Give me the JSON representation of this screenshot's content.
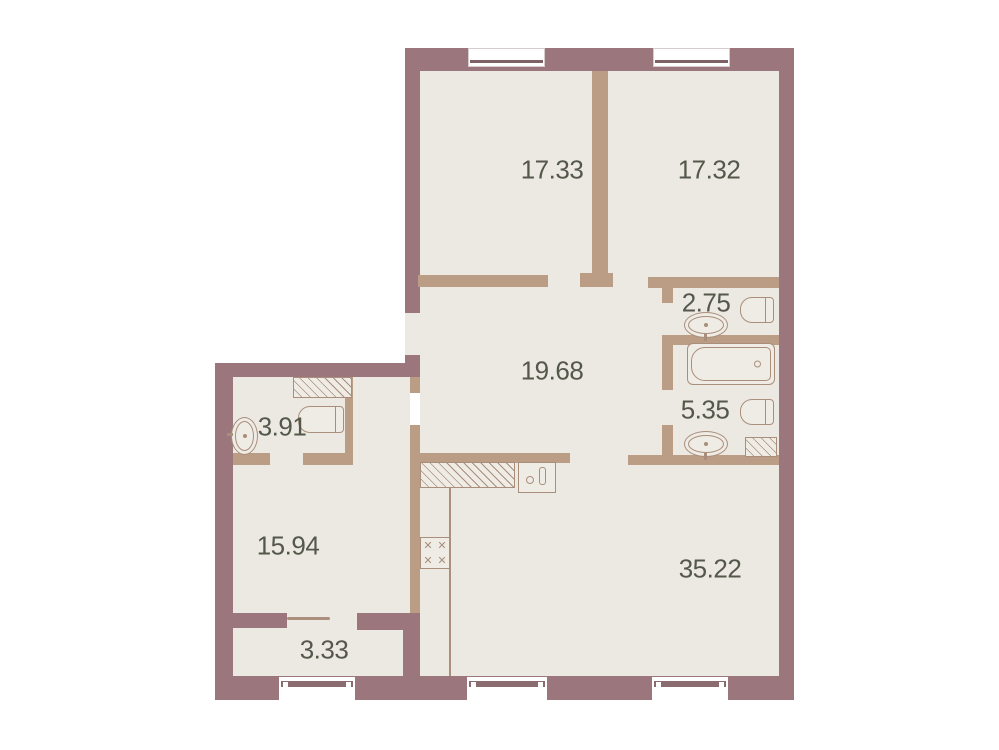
{
  "title": "apartment-floor-plan",
  "areas": {
    "bedroom_top_left": "17.33",
    "bedroom_top_right": "17.32",
    "wc_small": "2.75",
    "hallway": "19.68",
    "bathroom": "5.35",
    "wc_guest": "3.91",
    "room_left": "15.94",
    "living_kitchen": "35.22",
    "balcony": "3.33"
  },
  "colors": {
    "outer_wall": "#9b777d",
    "inner_wall": "#bb9c85",
    "floor": "#ece9e2",
    "label_text": "#54584b",
    "fixture_outline": "#a98e7c",
    "background": "#ffffff"
  },
  "fixtures": [
    "bathtub",
    "toilet",
    "oval-sink",
    "kitchen-sink",
    "stove",
    "kitchen-counter",
    "ventilation-shaft",
    "balcony-door",
    "window"
  ]
}
